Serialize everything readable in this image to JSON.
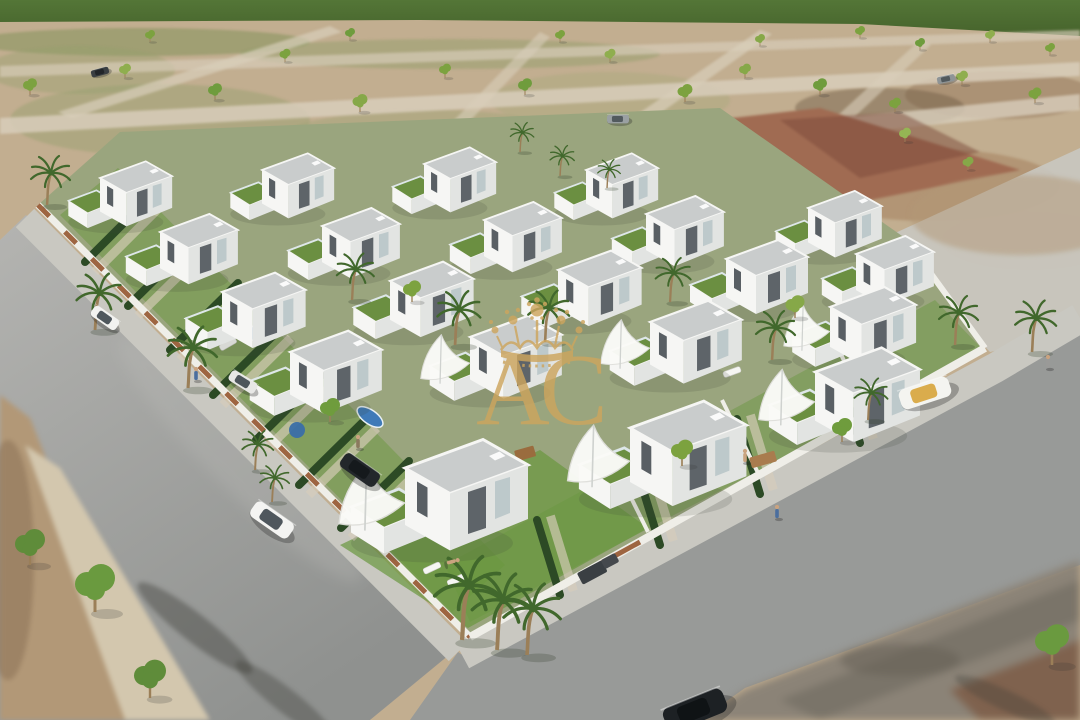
{
  "watermark": {
    "letters": "AC",
    "color": "#cda55e",
    "symbol": "crown"
  },
  "palette": {
    "field": "#4a6830",
    "field2": "#5a7c3c",
    "terrain": "#c2ae90",
    "dirt": "#b29877",
    "blurbeige": "#d3c7ae",
    "path": "#d8cebb",
    "road": "#a3a4a2",
    "asphalt": "#989a98",
    "sidewalk": "#c9c8c1",
    "wall": "#efeee8",
    "rust": "#96572f",
    "parcel": "#9aa57e",
    "lawn": "#69973e",
    "turf": "#6b8f41",
    "hedge": "#2c4a25",
    "white": "#f6f6f4",
    "shade": "#e2e4e2",
    "roof": "#c9cccc",
    "dark": "#323a40",
    "trunk": "#9b7f58",
    "palmleaf": "#41682c",
    "pool": "#3f7ab8",
    "pooldeck": "#6e68a8",
    "plaza1": "#a06b52",
    "plaza2": "#7c4a3a",
    "gold": "#cda55e",
    "parkblur": "#8b8377"
  },
  "scene": {
    "houses": [
      {
        "x": 100,
        "y": 178,
        "s": 0.88,
        "sail": 0
      },
      {
        "x": 262,
        "y": 170,
        "s": 0.88,
        "sail": 0
      },
      {
        "x": 424,
        "y": 164,
        "s": 0.88,
        "sail": 0
      },
      {
        "x": 586,
        "y": 170,
        "s": 0.88,
        "sail": 0
      },
      {
        "x": 160,
        "y": 232,
        "s": 0.95,
        "sail": 0
      },
      {
        "x": 322,
        "y": 226,
        "s": 0.95,
        "sail": 0
      },
      {
        "x": 484,
        "y": 220,
        "s": 0.95,
        "sail": 0
      },
      {
        "x": 646,
        "y": 214,
        "s": 0.95,
        "sail": 0
      },
      {
        "x": 808,
        "y": 208,
        "s": 0.9,
        "sail": 0
      },
      {
        "x": 222,
        "y": 292,
        "s": 1.02,
        "sail": 0
      },
      {
        "x": 390,
        "y": 281,
        "s": 1.02,
        "sail": 0
      },
      {
        "x": 558,
        "y": 270,
        "s": 1.02,
        "sail": 0
      },
      {
        "x": 726,
        "y": 259,
        "s": 1.0,
        "sail": 0
      },
      {
        "x": 856,
        "y": 254,
        "s": 0.95,
        "sail": 0
      },
      {
        "x": 290,
        "y": 352,
        "s": 1.12,
        "sail": 0
      },
      {
        "x": 470,
        "y": 337,
        "s": 1.12,
        "sail": 1
      },
      {
        "x": 650,
        "y": 322,
        "s": 1.12,
        "sail": 1
      },
      {
        "x": 830,
        "y": 307,
        "s": 1.05,
        "sail": 1
      },
      {
        "x": 405,
        "y": 468,
        "s": 1.5,
        "sail": 1
      },
      {
        "x": 630,
        "y": 428,
        "s": 1.42,
        "sail": 1
      },
      {
        "x": 815,
        "y": 372,
        "s": 1.28,
        "sail": 1
      }
    ],
    "palms": [
      {
        "x": 47,
        "y": 205,
        "s": 1.0
      },
      {
        "x": 95,
        "y": 330,
        "s": 1.15
      },
      {
        "x": 188,
        "y": 388,
        "s": 1.25
      },
      {
        "x": 352,
        "y": 300,
        "s": 0.95
      },
      {
        "x": 455,
        "y": 345,
        "s": 1.1
      },
      {
        "x": 545,
        "y": 342,
        "s": 1.05
      },
      {
        "x": 670,
        "y": 302,
        "s": 0.9
      },
      {
        "x": 772,
        "y": 360,
        "s": 1.0
      },
      {
        "x": 520,
        "y": 152,
        "s": 0.6
      },
      {
        "x": 560,
        "y": 176,
        "s": 0.62
      },
      {
        "x": 607,
        "y": 188,
        "s": 0.58
      },
      {
        "x": 255,
        "y": 470,
        "s": 0.8
      },
      {
        "x": 272,
        "y": 502,
        "s": 0.75
      },
      {
        "x": 462,
        "y": 640,
        "s": 1.7
      },
      {
        "x": 497,
        "y": 650,
        "s": 1.55
      },
      {
        "x": 527,
        "y": 655,
        "s": 1.45
      },
      {
        "x": 955,
        "y": 345,
        "s": 1.0
      },
      {
        "x": 1032,
        "y": 352,
        "s": 1.05
      },
      {
        "x": 868,
        "y": 420,
        "s": 0.85
      }
    ],
    "trees": [
      {
        "x": 30,
        "y": 95,
        "s": 0.7,
        "c": "#7ca23f"
      },
      {
        "x": 125,
        "y": 78,
        "s": 0.6,
        "c": "#8fae4e"
      },
      {
        "x": 215,
        "y": 100,
        "s": 0.7,
        "c": "#6f9c3d"
      },
      {
        "x": 285,
        "y": 62,
        "s": 0.55,
        "c": "#7ca23f"
      },
      {
        "x": 360,
        "y": 112,
        "s": 0.75,
        "c": "#86a848"
      },
      {
        "x": 445,
        "y": 78,
        "s": 0.6,
        "c": "#7ca23f"
      },
      {
        "x": 525,
        "y": 95,
        "s": 0.7,
        "c": "#6f9c3d"
      },
      {
        "x": 610,
        "y": 62,
        "s": 0.55,
        "c": "#8fae4e"
      },
      {
        "x": 685,
        "y": 102,
        "s": 0.75,
        "c": "#7ca23f"
      },
      {
        "x": 745,
        "y": 78,
        "s": 0.6,
        "c": "#86a848"
      },
      {
        "x": 820,
        "y": 95,
        "s": 0.7,
        "c": "#6f9c3d"
      },
      {
        "x": 895,
        "y": 112,
        "s": 0.6,
        "c": "#7ca23f"
      },
      {
        "x": 962,
        "y": 85,
        "s": 0.6,
        "c": "#8fae4e"
      },
      {
        "x": 1035,
        "y": 103,
        "s": 0.65,
        "c": "#7ca23f"
      },
      {
        "x": 860,
        "y": 38,
        "s": 0.5,
        "c": "#7ca23f"
      },
      {
        "x": 920,
        "y": 50,
        "s": 0.5,
        "c": "#6f9c3d"
      },
      {
        "x": 990,
        "y": 42,
        "s": 0.5,
        "c": "#8fae4e"
      },
      {
        "x": 1050,
        "y": 55,
        "s": 0.5,
        "c": "#7ca23f"
      },
      {
        "x": 350,
        "y": 40,
        "s": 0.5,
        "c": "#6f9c3d"
      },
      {
        "x": 560,
        "y": 42,
        "s": 0.5,
        "c": "#7ca23f"
      },
      {
        "x": 760,
        "y": 46,
        "s": 0.5,
        "c": "#86a848"
      },
      {
        "x": 150,
        "y": 42,
        "s": 0.5,
        "c": "#7ca23f"
      },
      {
        "x": 905,
        "y": 142,
        "s": 0.6,
        "c": "#95b554"
      },
      {
        "x": 968,
        "y": 170,
        "s": 0.55,
        "c": "#86a848"
      },
      {
        "x": 30,
        "y": 565,
        "s": 1.5,
        "c": "#5f8c3a"
      },
      {
        "x": 95,
        "y": 612,
        "s": 2.0,
        "c": "#6a9a3f"
      },
      {
        "x": 150,
        "y": 698,
        "s": 1.6,
        "c": "#5f8c3a"
      },
      {
        "x": 1052,
        "y": 665,
        "s": 1.7,
        "c": "#6a9a3f"
      },
      {
        "x": 330,
        "y": 422,
        "s": 1.0,
        "c": "#6f9c3d"
      },
      {
        "x": 412,
        "y": 302,
        "s": 0.9,
        "c": "#7ca23f"
      },
      {
        "x": 682,
        "y": 466,
        "s": 1.1,
        "c": "#7ca23f"
      },
      {
        "x": 795,
        "y": 318,
        "s": 0.95,
        "c": "#86a848"
      },
      {
        "x": 842,
        "y": 442,
        "s": 1.0,
        "c": "#6f9c3d"
      }
    ],
    "hedges": [
      {
        "x1": 85,
        "y1": 262,
        "x2": 152,
        "y2": 195
      },
      {
        "x1": 128,
        "y1": 306,
        "x2": 196,
        "y2": 239
      },
      {
        "x1": 170,
        "y1": 350,
        "x2": 238,
        "y2": 283
      },
      {
        "x1": 213,
        "y1": 395,
        "x2": 281,
        "y2": 328
      },
      {
        "x1": 256,
        "y1": 440,
        "x2": 324,
        "y2": 373
      },
      {
        "x1": 299,
        "y1": 485,
        "x2": 367,
        "y2": 418
      },
      {
        "x1": 341,
        "y1": 528,
        "x2": 409,
        "y2": 461
      },
      {
        "x1": 560,
        "y1": 595,
        "x2": 537,
        "y2": 520
      },
      {
        "x1": 660,
        "y1": 545,
        "x2": 637,
        "y2": 470
      },
      {
        "x1": 760,
        "y1": 494,
        "x2": 737,
        "y2": 419
      },
      {
        "x1": 860,
        "y1": 443,
        "x2": 837,
        "y2": 368
      }
    ],
    "pools": [
      {
        "x": 252,
        "y": 333,
        "rx": 13,
        "ry": 6
      },
      {
        "x": 307,
        "y": 372,
        "rx": 14,
        "ry": 6
      },
      {
        "x": 370,
        "y": 417,
        "rx": 15,
        "ry": 7
      }
    ],
    "discs": [
      {
        "x": 297,
        "y": 430,
        "r": 8,
        "c": "#3a6ea8"
      },
      {
        "x": 910,
        "y": 405,
        "r": 7,
        "c": "#2e7f8a"
      }
    ],
    "loungers": [
      {
        "x": 432,
        "y": 568,
        "a": -25
      },
      {
        "x": 456,
        "y": 580,
        "a": -25
      },
      {
        "x": 700,
        "y": 468,
        "a": -20
      },
      {
        "x": 722,
        "y": 480,
        "a": -20
      },
      {
        "x": 210,
        "y": 336,
        "a": -30
      },
      {
        "x": 228,
        "y": 344,
        "a": -30
      },
      {
        "x": 712,
        "y": 362,
        "a": -20
      },
      {
        "x": 732,
        "y": 372,
        "a": -20
      }
    ],
    "cars": [
      {
        "x": 105,
        "y": 318,
        "a": 35,
        "l": 30,
        "c": "#f2f2f0",
        "w": "#3d464d"
      },
      {
        "x": 272,
        "y": 520,
        "a": 35,
        "l": 46,
        "c": "#f4f4f2",
        "w": "#3d464d"
      },
      {
        "x": 360,
        "y": 470,
        "a": 35,
        "l": 42,
        "c": "#23272b",
        "w": "#14181b"
      },
      {
        "x": 243,
        "y": 382,
        "a": 32,
        "l": 30,
        "c": "#e8e8e6",
        "w": "#3d464d"
      },
      {
        "x": 925,
        "y": 393,
        "a": -18,
        "l": 52,
        "c": "#f4f4f0",
        "w": "#d7a43a"
      },
      {
        "x": 695,
        "y": 710,
        "a": -22,
        "l": 64,
        "c": "#1d2124",
        "w": "#0e1214"
      },
      {
        "x": 618,
        "y": 119,
        "a": 0,
        "l": 22,
        "c": "#9aa0a2",
        "w": "#4a5257"
      },
      {
        "x": 100,
        "y": 72,
        "a": -15,
        "l": 18,
        "c": "#3a3f42",
        "w": "#202427"
      },
      {
        "x": 946,
        "y": 79,
        "a": -12,
        "l": 18,
        "c": "#8e9496",
        "w": "#4a5257"
      }
    ],
    "people": [
      {
        "x": 196,
        "y": 380,
        "c": "#4a6e9e",
        "lying": 0
      },
      {
        "x": 358,
        "y": 448,
        "c": "#8a795f",
        "lying": 0
      },
      {
        "x": 777,
        "y": 518,
        "c": "#4a6e9e",
        "lying": 0
      },
      {
        "x": 1048,
        "y": 368,
        "c": "#9a9a98",
        "lying": 0
      },
      {
        "x": 447,
        "y": 563,
        "c": "#caa37f",
        "lying": 1
      },
      {
        "x": 745,
        "y": 462,
        "c": "#caa37f",
        "lying": 0
      }
    ]
  }
}
